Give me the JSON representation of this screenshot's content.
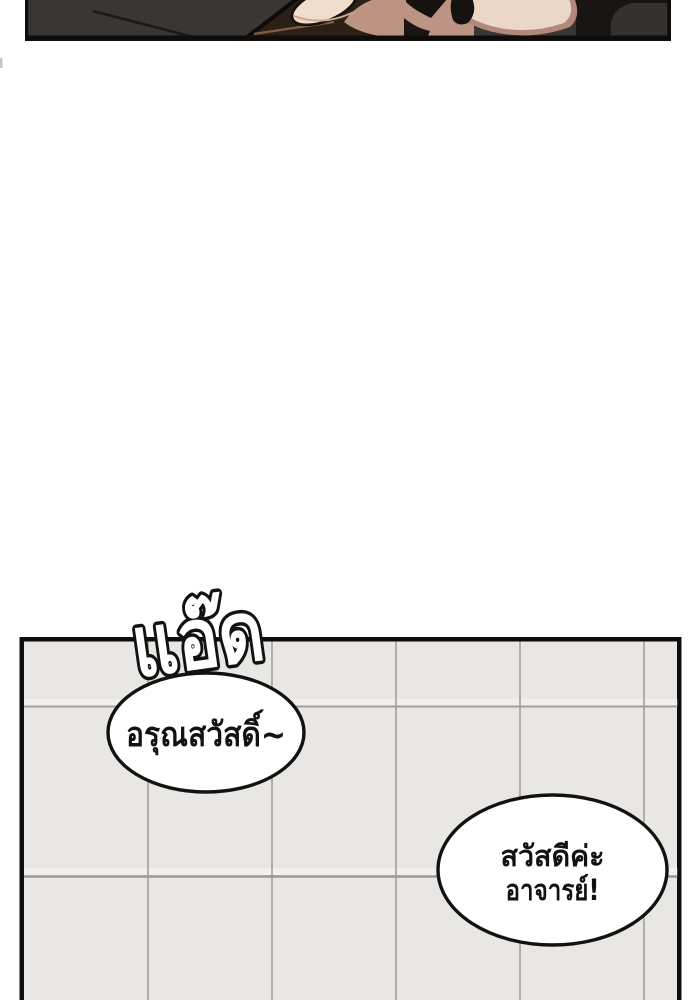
{
  "comic": {
    "sfx": {
      "text": "แอ๊ด"
    },
    "bubbles": [
      {
        "text": "อรุณสวัสดิ์~"
      },
      {
        "line1": "สวัสดีค่ะ",
        "line2": "อาจารย์!"
      }
    ]
  },
  "colors": {
    "panel_border": "#0e0d0c",
    "top_panel_bg": "#393634",
    "phone": "#2b1f16",
    "skin": "#ead7c6",
    "skin_shadow": "#bd9483",
    "thumb": "#f0ddcb",
    "sleeve": "#191514",
    "tile": "#e8e7e5",
    "tile_grout": "#a9a8a5",
    "bubble_fill": "#ffffff",
    "text": "#141210",
    "sfx_outline": "#14120f"
  }
}
